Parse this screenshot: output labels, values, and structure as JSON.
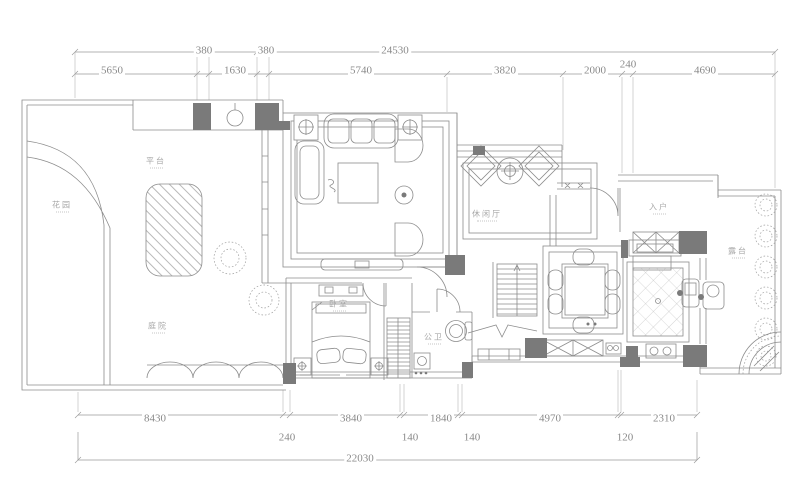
{
  "drawing": {
    "type": "residential-floor-plan",
    "colors": {
      "background": "#ffffff",
      "line": "#8c8c8c",
      "wall_fill": "#7a7a7a",
      "dimension_text": "#8a8a8a",
      "room_text": "#a8a8a8"
    },
    "dims": {
      "overall_top": "24530",
      "top_row1": [
        "380",
        "380"
      ],
      "top_row2": [
        "5650",
        "1630",
        "5740",
        "3820",
        "2000",
        "240",
        "4690"
      ],
      "bottom_row1": [
        "8430",
        "3840",
        "1840",
        "4970",
        "2310"
      ],
      "bottom_row2": [
        "240",
        "140",
        "140",
        "120"
      ],
      "overall_bottom": "22030"
    },
    "rooms": {
      "garden": "花园",
      "platform": "平台",
      "courtyard": "庭院",
      "bedroom": "卧室",
      "bath": "公卫",
      "lounge": "休闲厅",
      "entry": "入户",
      "terrace": "露台"
    }
  }
}
